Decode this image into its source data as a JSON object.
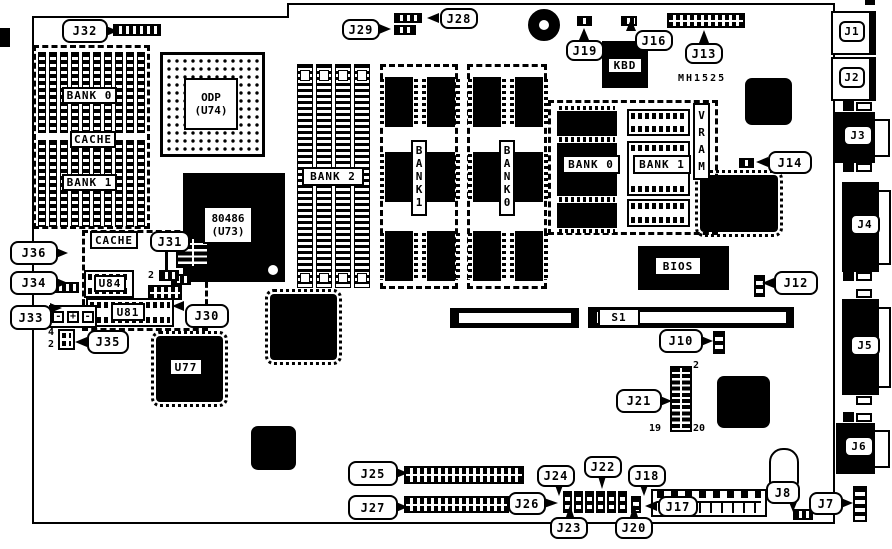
{
  "diagram": {
    "kind": "motherboard-component-layout",
    "board_id": "MH1525"
  },
  "refs": {
    "j1": "J1",
    "j2": "J2",
    "j3": "J3",
    "j4": "J4",
    "j5": "J5",
    "j6": "J6",
    "j7": "J7",
    "j8": "J8",
    "j10": "J10",
    "j12": "J12",
    "j13": "J13",
    "j14": "J14",
    "j16": "J16",
    "j17": "J17",
    "j18": "J18",
    "j19": "J19",
    "j20": "J20",
    "j21": "J21",
    "j22": "J22",
    "j23": "J23",
    "j24": "J24",
    "j25": "J25",
    "j26": "J26",
    "j27": "J27",
    "j28": "J28",
    "j29": "J29",
    "j30": "J30",
    "j31": "J31",
    "j32": "J32",
    "j33": "J33",
    "j34": "J34",
    "j35": "J35",
    "j36": "J36",
    "s1": "S1"
  },
  "chips": {
    "cpu_l1": "80486",
    "cpu_l2": "(U73)",
    "odp_l1": "ODP",
    "odp_l2": "(U74)",
    "u77": "U77",
    "u81": "U81",
    "u84": "U84",
    "bios": "BIOS",
    "kbd": "KBD"
  },
  "memory": {
    "bank0": "BANK 0",
    "bank1": "BANK 1",
    "bank2": "BANK 2",
    "cache": "CACHE",
    "vram": "VRAM",
    "mid_bank1_vertical": "BANK1",
    "mid_bank0_vertical": "BANK0"
  },
  "pin_numbers": {
    "j21_top": "2",
    "j21_bottom_left": "19",
    "j21_bottom_right": "20",
    "j31_pin": "2",
    "j35_top": "4",
    "j35_bottom": "2"
  },
  "battery": {
    "neg": "-",
    "pos": "+"
  }
}
